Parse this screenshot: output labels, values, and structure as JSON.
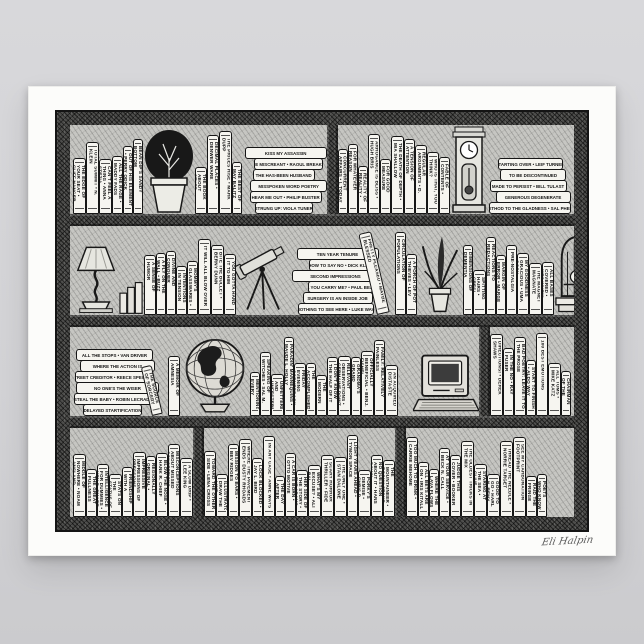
{
  "poster": {
    "signature": "Eli Halpin",
    "palette": {
      "wall": "#d4d4d7",
      "paper": "#fcfcfa",
      "ink": "#1a1a1a",
      "wood": "#4e4e4c"
    }
  },
  "bookshelf": {
    "shelves": [
      {
        "name": "shelf-1",
        "items": [
          {
            "type": "vbook",
            "title": "THE EDGE OF YOUR SEAT • Cliff Hanger"
          },
          {
            "type": "vbook",
            "title": "TOTAL SUMMIT • N. Klein"
          },
          {
            "type": "vbook",
            "title": "CAN'T FEEL A THING • Anna Stezia"
          },
          {
            "type": "vbook",
            "title": "ALL THE RAGE • Maddy Fads"
          },
          {
            "type": "vbook",
            "title": "OUT OF HIS ELEMENT • Perry Odick"
          },
          {
            "type": "vbook",
            "title": "BEAN DIP'S SANDY BOTTOM"
          },
          {
            "type": "object",
            "object": "potted-plant"
          },
          {
            "type": "vbook",
            "title": "THE BOOK ABOUT STUFF • Alma Nack"
          },
          {
            "type": "vbook",
            "title": "DECIMAL PLACES • Denwer Ware"
          },
          {
            "type": "vbook",
            "title": "THE PRICES RISE • Mark Dupp"
          },
          {
            "type": "vbook",
            "title": "THE BEST OF MAY BALITZ"
          },
          {
            "type": "gap"
          },
          {
            "type": "hstack",
            "books": [
              "KISS MY ASSASSIN",
              "THE MISCREANT • Raoul Breaker",
              "THE HAS-BEEN HUSBAND",
              "MISSPOKEN WORD POETRY",
              "HEAR ME OUT • Philip Buster",
              "STRUNG UP: VIOLA TUNER"
            ]
          },
          {
            "type": "post"
          },
          {
            "type": "vbook",
            "title": "CONCURRENT AFFAIRS • I. Today"
          },
          {
            "type": "vbook",
            "title": "FOR WHATEVER REASON"
          },
          {
            "type": "vbook",
            "title": "REALITY OF REALITY • Mort Gage"
          },
          {
            "type": "vbook",
            "title": "ARROGANCE IS BLISS • Hugh Bris"
          },
          {
            "type": "vbook",
            "title": "FOR GOOD MEASURE"
          },
          {
            "type": "vbook",
            "title": "THE DEATH OF DEPTH • Mia Shallow"
          },
          {
            "type": "vbook",
            "title": "A TENSION OF ATTENTION"
          },
          {
            "type": "vbook",
            "title": "REGULAR ARGUMENTS • D. Bails"
          },
          {
            "type": "vbook",
            "title": "WHO IS THAT, YOU THINK?"
          },
          {
            "type": "vbook",
            "title": "FABLE OF CONTENTS • Faye Altais"
          },
          {
            "type": "gap"
          },
          {
            "type": "object",
            "object": "grandfather-clock"
          },
          {
            "type": "gap"
          },
          {
            "type": "hstack",
            "books": [
              "STARTING OVER • Leif Turner",
              "TO BE DISCONTINUED",
              "MADE TO PERSIST • Bill Tulast",
              "GENEROUS DEGENERATE",
              "METHOD TO THE GLADNESS • Sal Phelp"
            ]
          }
        ]
      },
      {
        "name": "shelf-2",
        "items": [
          {
            "type": "object",
            "object": "table-lamp"
          },
          {
            "type": "object",
            "object": "mini-books"
          },
          {
            "type": "vbook",
            "title": "A SENSE OF HUMOR"
          },
          {
            "type": "vbook",
            "title": "A FLY ON THE WALL • Buzz Word"
          },
          {
            "type": "vbook",
            "title": "DIVINE AND CONQUER"
          },
          {
            "type": "vbook",
            "title": "INTENTIONS IN TENSION"
          },
          {
            "type": "vbook",
            "title": "MOMMY'S GLASSWARES • Neva Way"
          },
          {
            "type": "vbook",
            "title": "IT WILL ALL BLOW OVER"
          },
          {
            "type": "vbook",
            "title": "BITE THE BULLET • Berny Dunn"
          },
          {
            "type": "vbook",
            "title": "YOU GOTTA HAND IT TO HIM"
          },
          {
            "type": "object",
            "object": "telescope"
          },
          {
            "type": "hstack",
            "books": [
              "TEN YEAR TENURE",
              "HOW TO SAY NO • Dick Klein",
              "SECOND IMPRESSIONS",
              "WILL YOU CARRY ME? • Paul Bearer",
              "SURGERY IS AN INSIDE JOB",
              "NOTHING TO SEE HERE • Luke Way"
            ]
          },
          {
            "type": "lean",
            "dir": "left",
            "title": "PRETTY PLEASED • Maybe Blessed"
          },
          {
            "type": "vbook",
            "title": "CIRCULATION OF POPULATIONS"
          },
          {
            "type": "gap"
          },
          {
            "type": "vbook",
            "title": "A PORCH OF POT THIEVES • Lev"
          },
          {
            "type": "object",
            "object": "feather-plant"
          },
          {
            "type": "vbook",
            "title": "DIMENSIONS OF DEMENTIA"
          },
          {
            "type": "vbook",
            "title": "SPITTING HAIRS • Cresi Green"
          },
          {
            "type": "vbook",
            "title": "REACTIONS TO REDACTIONS"
          },
          {
            "type": "vbook",
            "title": "MARGIN OF ERROR • Marge Inovera"
          },
          {
            "type": "vbook",
            "title": "PRE-NOSTALGIA"
          },
          {
            "type": "vbook",
            "title": "MY GOODNESS GRACIOUS • Uma Gosh"
          },
          {
            "type": "vbook",
            "title": "THE MAGNET MAGNATE"
          },
          {
            "type": "vbook",
            "title": "ALL BASES COVERED • Wes Whew"
          },
          {
            "type": "object",
            "object": "birdcage"
          }
        ]
      },
      {
        "name": "shelf-3",
        "items": [
          {
            "type": "hstack",
            "books": [
              "ALL THE STOPS • Van Driver",
              "WHERE THE ACTION IS",
              "STREET CREDITOR • Reece Specter",
              "NO ONE'S THE WISER",
              "STEAL THE BABY • Robin LeCradle",
              "DELAYED STARTIFICATION"
            ]
          },
          {
            "type": "lean",
            "dir": "left",
            "title": "THE SOURCE OF SORCERY"
          },
          {
            "type": "vbook",
            "title": "A MEMOIR OF AMNESIA"
          },
          {
            "type": "object",
            "object": "globe"
          },
          {
            "type": "vbook",
            "title": "MENTIONING EVERY MENTION"
          },
          {
            "type": "vbook",
            "title": "SPEAKING OF WITCHES • Sal M. Trials"
          },
          {
            "type": "vbook",
            "title": "UNFETTERED AND UNFESTERED"
          },
          {
            "type": "vbook",
            "title": "PARADIN' MANNEQUINS • Maude L. Holly"
          },
          {
            "type": "vbook",
            "title": "FRIDAY EVENING CORNERBACK"
          },
          {
            "type": "vbook",
            "title": "THE ACCOMPLISHED ACCOMPLICE"
          },
          {
            "type": "vbook",
            "title": "THE MODERN CONSERVATIVE • Eileen Wright"
          },
          {
            "type": "vbook",
            "title": "I DON'T KNOW THE HALF OF IT"
          },
          {
            "type": "vbook",
            "title": "RELEVANT OBSERVATIONS • Germaine Point"
          },
          {
            "type": "vbook",
            "title": "GRANDMA'S GRAND GRAMMAR"
          },
          {
            "type": "vbook",
            "title": "OFFICIALLY BENEFICIAL • Benj. Fishel"
          },
          {
            "type": "vbook",
            "title": "FAMILY: RELATIVELY PAINLESS"
          },
          {
            "type": "vbook",
            "title": "AN ACQUIRED DISTASTE"
          },
          {
            "type": "gap"
          },
          {
            "type": "object",
            "object": "computer"
          },
          {
            "type": "post"
          },
          {
            "type": "vbook",
            "title": "DIRECTIONS! • Derek Shaws"
          },
          {
            "type": "vbook",
            "title": "IN THE NO • Ray Fuser"
          },
          {
            "type": "vbook",
            "title": "BAD POETRY: LEAVE IT TO THE PROSE"
          },
          {
            "type": "vbook",
            "title": "START TO FINISH • Aldo Way"
          },
          {
            "type": "vbook",
            "title": "100 BEST EMOTIONS"
          },
          {
            "type": "vbook",
            "title": "ALL TOMS • Mike Katz"
          },
          {
            "type": "vbook",
            "title": "CHAIRMAN OF THE BEARD"
          }
        ]
      },
      {
        "name": "shelf-4",
        "items": [
          {
            "type": "vbook",
            "title": "MIDDLE OF NOWHERE • Noam Ansland"
          },
          {
            "type": "vbook",
            "title": "THE GREAT FULLNESS OF GRATEFULNESS"
          },
          {
            "type": "vbook",
            "title": "INTELLIGENCE FOR DUMMIES • Ken B. Smart"
          },
          {
            "type": "vbook",
            "title": "STATS ON THE STATUS OF THE STATE"
          },
          {
            "type": "vbook",
            "title": "FRIENDSHIP WITH A FRENCH CHIMP • Fred Chips"
          },
          {
            "type": "vbook",
            "title": "IMPRESSIVE IMPRESSIONS OF PRESSIONS"
          },
          {
            "type": "vbook",
            "title": "REGIONALLY ORIGINAL • Reginald O'Regionals"
          },
          {
            "type": "vbook",
            "title": "BLOW THE NOSE • Hank R. Chief"
          },
          {
            "type": "vbook",
            "title": "MISCONCEPTIONS ABOUT MISSED CONCEPTIONS"
          },
          {
            "type": "vbook",
            "title": "A SLOW DRIP • Lee King"
          },
          {
            "type": "post"
          },
          {
            "type": "vbook",
            "title": "TOWARD THE OTHER SIDE • Lena Cross"
          },
          {
            "type": "vbook",
            "title": "ILLUSTRATORS DRAW THE LINE SOMEWHERE • Penny Penn"
          },
          {
            "type": "vbook",
            "title": "MISSION TO BARS • Bev Ridges"
          },
          {
            "type": "vbook",
            "title": "WHERE THE PAVEMENT ENDS • Dusty Rhoads"
          },
          {
            "type": "vbook",
            "title": "LOCK BLOCKED • Jay L. Bird"
          },
          {
            "type": "vbook",
            "title": "IN ANY CASE • Anne Ways"
          },
          {
            "type": "vbook",
            "title": "THE DAY AFTER YESTERDAY • Todd A."
          },
          {
            "type": "vbook",
            "title": "A CAR IS BORN • Otto Motive"
          },
          {
            "type": "vbook",
            "title": "HER SIDE OF THE STORY • Eve Adams"
          },
          {
            "type": "vbook",
            "title": "WHAT'S MY EXCUSE? • Ali Bai"
          },
          {
            "type": "vbook",
            "title": "SCARY HORROR THRILLER • Fide"
          },
          {
            "type": "vbook",
            "title": "THE ONLY ONE • Stan Dalone"
          },
          {
            "type": "vbook",
            "title": "LIGHT YEARS AHEAD • Tymon Space"
          },
          {
            "type": "vbook",
            "title": "PORKY'S DEMISE • Chris P. Bacon"
          },
          {
            "type": "vbook",
            "title": "NO QUESTION ABOUT IT • Hans Down"
          },
          {
            "type": "vbook",
            "title": "THE MOUNTAINEER • Rocky Stone"
          },
          {
            "type": "post"
          },
          {
            "type": "vbook",
            "title": "TOO MUCH TO DRINK • Carrie Mehome"
          },
          {
            "type": "vbook",
            "title": "ALL BETS ARE ON • Iris Kitall"
          },
          {
            "type": "vbook",
            "title": "WHERE THE LAVA FLOWS • Val Kano"
          },
          {
            "type": "vbook",
            "title": "AT YOUR SERVICE • Beck N. Call"
          },
          {
            "type": "vbook",
            "title": "JUDGE THIS COVER • Booker Looke"
          },
          {
            "type": "vbook",
            "title": "THE OLDEST TRICKS IN THE MIX"
          },
          {
            "type": "vbook",
            "title": "STARING AT THE SEA • Clive Atwater"
          },
          {
            "type": "vbook",
            "title": "GOOD TO GO • Harl N. Remy"
          },
          {
            "type": "vbook",
            "title": "THREAD THE NEEDLE • Norrie Target"
          },
          {
            "type": "vbook",
            "title": "SEE MY CARBONATION FOOTPRINT"
          },
          {
            "type": "vbook",
            "title": "RAID THE FRINGE"
          },
          {
            "type": "vbook",
            "title": "POETS WHO KNOW IT"
          }
        ]
      }
    ]
  }
}
